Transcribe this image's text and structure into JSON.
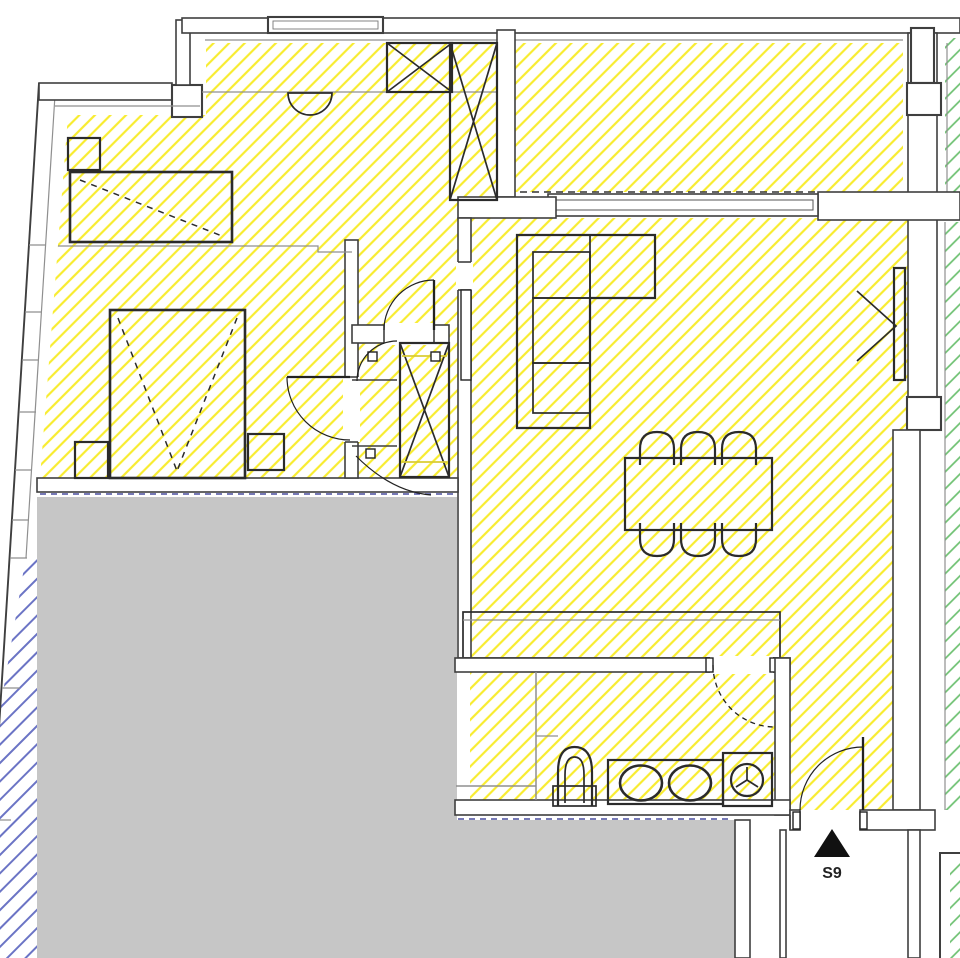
{
  "entrance": {
    "label": "S9",
    "marker": "up-triangle-icon"
  },
  "colors": {
    "yellow_hatch": "#f8ec30",
    "green_hatch": "#6cc070",
    "blue_hatch": "#6b74c5",
    "terrace_fill": "#c6c6c6",
    "wall_line": "#3f3f3f",
    "wall_line_light": "#8f8f8f",
    "furniture_line": "#2b2b2b",
    "terrace_edge_dash": "#4a4f9e",
    "closet_shelf_line": "#d9cb35",
    "label_text": "#222222",
    "marker_fill": "#111111"
  },
  "regions": {
    "yellow": "apartment-interior",
    "green": "adjacent-unit",
    "blue": "facade-strip",
    "gray": "terrace"
  }
}
